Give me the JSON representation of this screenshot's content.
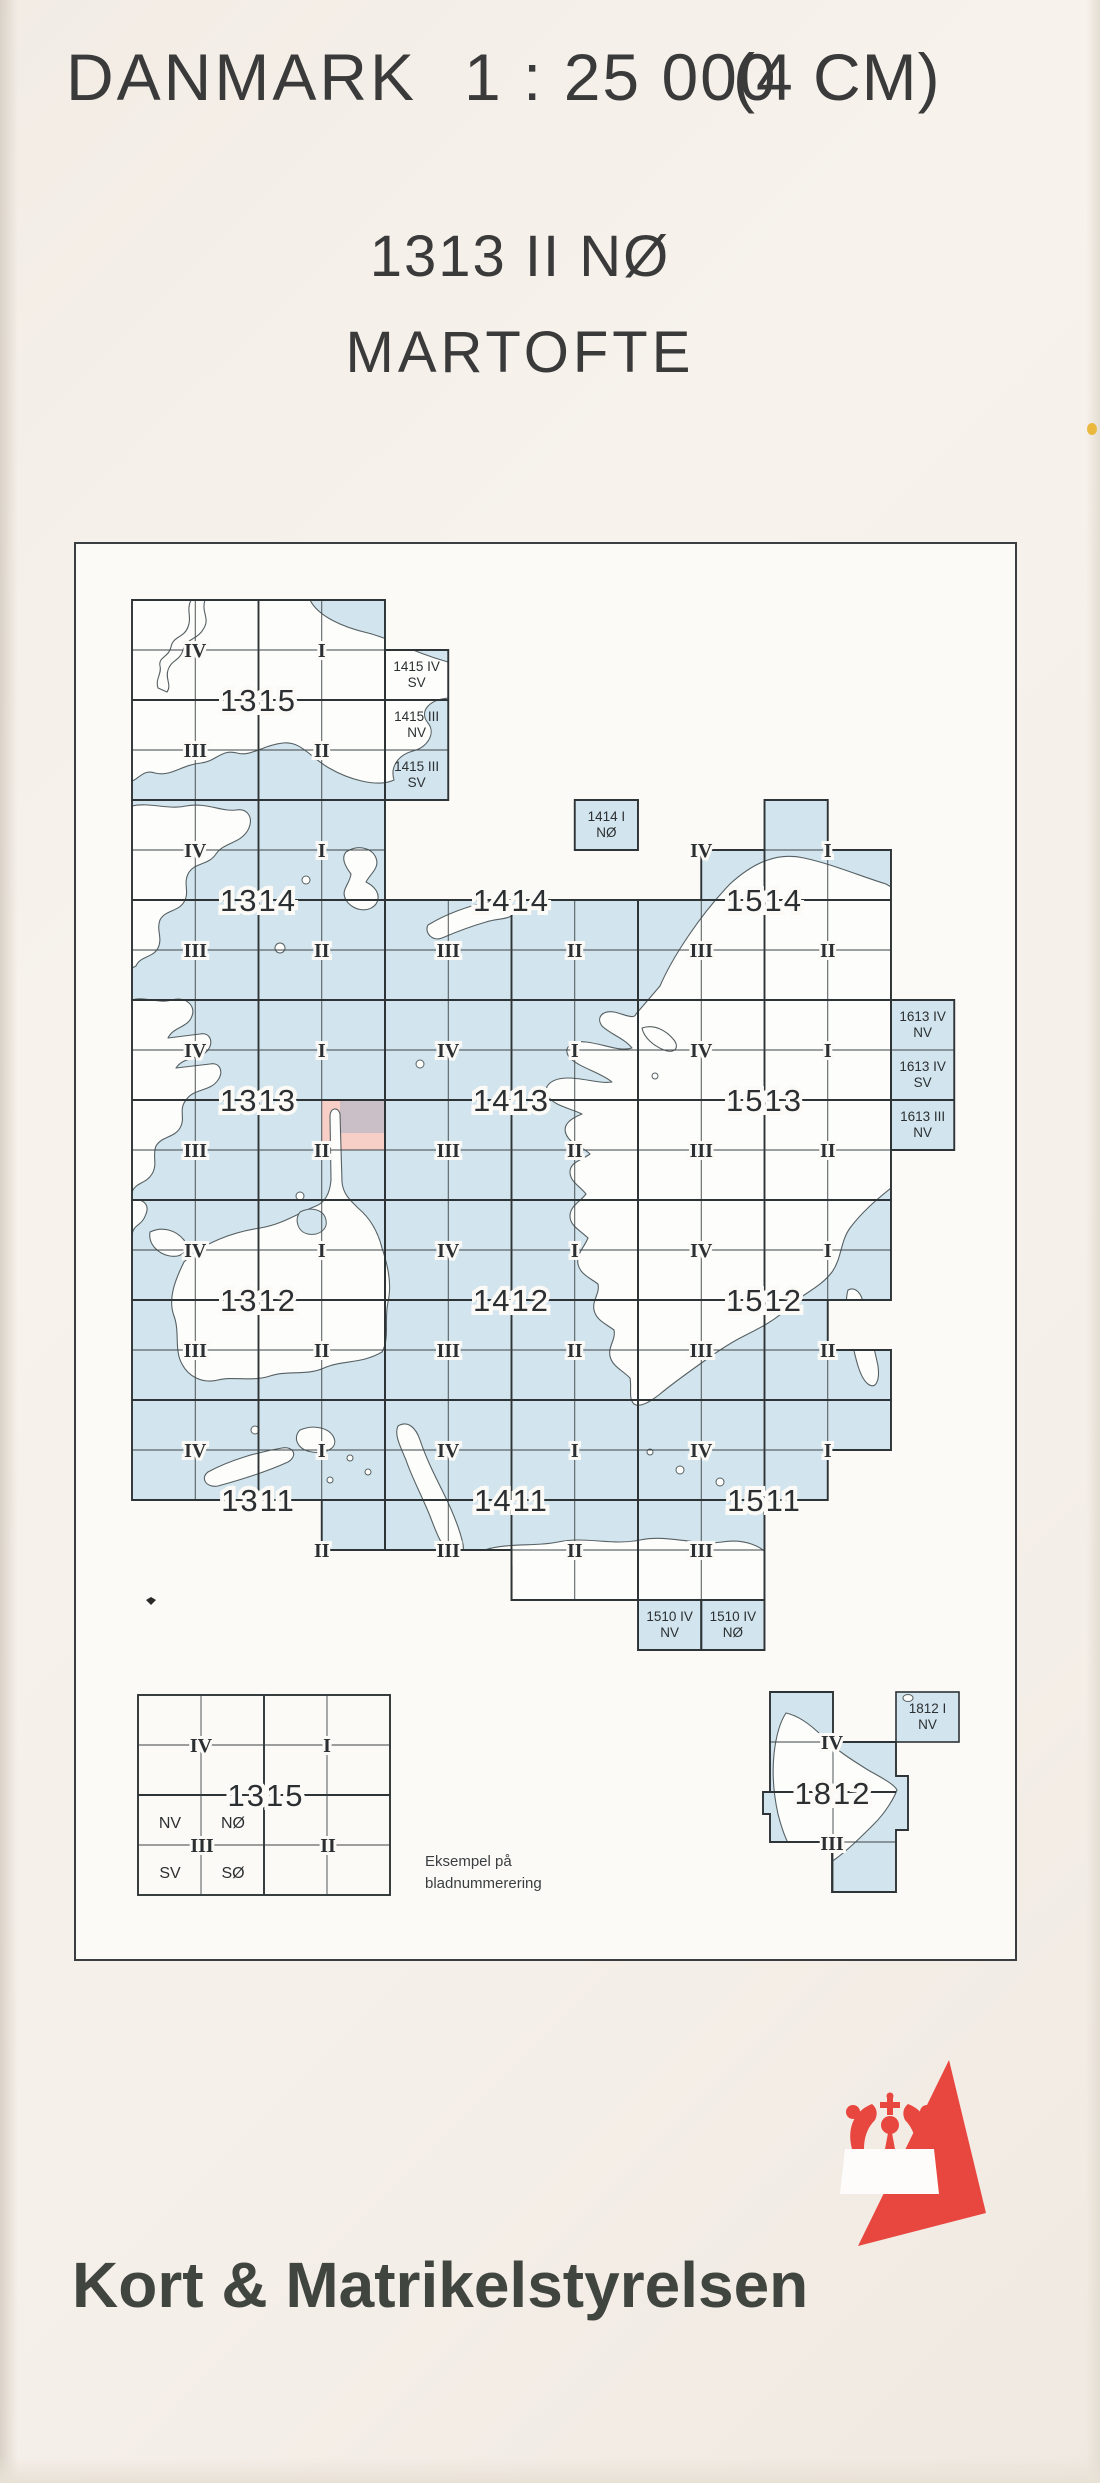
{
  "page": {
    "country": "DANMARK",
    "scale": "1 : 25 000",
    "cm_note": "(4 CM)",
    "sheet_number": "1313 II NØ",
    "sheet_name": "MARTOFTE",
    "publisher": "Kort & Matrikelstyrelsen"
  },
  "colors": {
    "sea": "#d2e4ed",
    "paper_in": "#fbfaf7",
    "line": "#2e3335",
    "thin_line": "#3d4345",
    "coast": "#566063",
    "land": "#fdfdfb",
    "pink": "#f7cfc7",
    "gray_tint": "#c2bcc6",
    "label": "#2b2f31",
    "red": "#e8473f",
    "frame": "#3a3e40",
    "mark": "#2c2a28",
    "spot_yellow": "#e9b83d"
  },
  "index_map": {
    "frame_px": [
      75,
      543,
      1016,
      1960
    ],
    "grid": {
      "x0": 132,
      "y0": 600,
      "cell_w": 63.25,
      "cell_h": 50
    },
    "sea_cells": [
      [
        0,
        0,
        4,
        4
      ],
      [
        4,
        1,
        5,
        4
      ],
      [
        0,
        4,
        4,
        8
      ],
      [
        4,
        6,
        8,
        8
      ],
      [
        7,
        4,
        8,
        5
      ],
      [
        8,
        6,
        12,
        8
      ],
      [
        9,
        5,
        12,
        6
      ],
      [
        10,
        4,
        11,
        5
      ],
      [
        0,
        8,
        4,
        12
      ],
      [
        4,
        8,
        8,
        12
      ],
      [
        8,
        8,
        12,
        12
      ],
      [
        12,
        8,
        13,
        11
      ],
      [
        0,
        12,
        4,
        16
      ],
      [
        4,
        12,
        8,
        16
      ],
      [
        8,
        12,
        11,
        16
      ],
      [
        11,
        12,
        12,
        14
      ],
      [
        11,
        15,
        12,
        16
      ],
      [
        0,
        16,
        4,
        18
      ],
      [
        3,
        18,
        4,
        19
      ],
      [
        4,
        16,
        8,
        19
      ],
      [
        6,
        19,
        8,
        20
      ],
      [
        8,
        16,
        12,
        17
      ],
      [
        8,
        17,
        11,
        18
      ],
      [
        8,
        18,
        10,
        20
      ],
      [
        8,
        20,
        9,
        21
      ],
      [
        9,
        20,
        10,
        21
      ]
    ],
    "outlines": [
      [
        [
          0,
          0
        ],
        [
          4,
          0
        ],
        [
          4,
          4
        ],
        [
          0,
          4
        ]
      ],
      [
        [
          4,
          1
        ],
        [
          5,
          1
        ],
        [
          5,
          4
        ],
        [
          4,
          4
        ]
      ],
      [
        [
          0,
          4
        ],
        [
          4,
          4
        ],
        [
          4,
          8
        ],
        [
          0,
          8
        ]
      ],
      [
        [
          4,
          6
        ],
        [
          8,
          6
        ],
        [
          8,
          8
        ],
        [
          4,
          8
        ]
      ],
      [
        [
          7,
          4
        ],
        [
          8,
          4
        ],
        [
          8,
          5
        ],
        [
          7,
          5
        ]
      ],
      [
        [
          8,
          6
        ],
        [
          9,
          6
        ],
        [
          9,
          5
        ],
        [
          10,
          5
        ],
        [
          10,
          4
        ],
        [
          11,
          4
        ],
        [
          11,
          5
        ],
        [
          12,
          5
        ],
        [
          12,
          8
        ],
        [
          8,
          8
        ]
      ],
      [
        [
          0,
          8
        ],
        [
          4,
          8
        ],
        [
          4,
          12
        ],
        [
          0,
          12
        ]
      ],
      [
        [
          4,
          8
        ],
        [
          8,
          8
        ],
        [
          8,
          12
        ],
        [
          4,
          12
        ]
      ],
      [
        [
          8,
          8
        ],
        [
          12,
          8
        ],
        [
          12,
          12
        ],
        [
          8,
          12
        ]
      ],
      [
        [
          12,
          8
        ],
        [
          13,
          8
        ],
        [
          13,
          11
        ],
        [
          12,
          11
        ]
      ],
      [
        [
          0,
          12
        ],
        [
          4,
          12
        ],
        [
          4,
          16
        ],
        [
          0,
          16
        ]
      ],
      [
        [
          4,
          12
        ],
        [
          8,
          12
        ],
        [
          8,
          16
        ],
        [
          4,
          16
        ]
      ],
      [
        [
          8,
          12
        ],
        [
          12,
          12
        ],
        [
          12,
          14
        ],
        [
          11,
          14
        ],
        [
          11,
          15
        ],
        [
          12,
          15
        ],
        [
          12,
          16
        ],
        [
          8,
          16
        ]
      ],
      [
        [
          0,
          16
        ],
        [
          4,
          16
        ],
        [
          4,
          19
        ],
        [
          3,
          19
        ],
        [
          3,
          18
        ],
        [
          0,
          18
        ]
      ],
      [
        [
          4,
          16
        ],
        [
          8,
          16
        ],
        [
          8,
          20
        ],
        [
          6,
          20
        ],
        [
          6,
          19
        ],
        [
          4,
          19
        ]
      ],
      [
        [
          8,
          16
        ],
        [
          12,
          16
        ],
        [
          12,
          17
        ],
        [
          11,
          17
        ],
        [
          11,
          18
        ],
        [
          10,
          18
        ],
        [
          10,
          20
        ],
        [
          8,
          20
        ]
      ],
      [
        [
          8,
          20
        ],
        [
          9,
          20
        ],
        [
          9,
          21
        ],
        [
          8,
          21
        ]
      ],
      [
        [
          9,
          20
        ],
        [
          10,
          20
        ],
        [
          10,
          21
        ],
        [
          9,
          21
        ]
      ]
    ],
    "block_labels": [
      {
        "t": "1315",
        "ci": 2,
        "rj": 2
      },
      {
        "t": "1314",
        "ci": 2,
        "rj": 6
      },
      {
        "t": "1414",
        "ci": 6,
        "rj": 6
      },
      {
        "t": "1514",
        "ci": 10,
        "rj": 6
      },
      {
        "t": "1313",
        "ci": 2,
        "rj": 10
      },
      {
        "t": "1413",
        "ci": 6,
        "rj": 10
      },
      {
        "t": "1513",
        "ci": 10,
        "rj": 10
      },
      {
        "t": "1312",
        "ci": 2,
        "rj": 14
      },
      {
        "t": "1412",
        "ci": 6,
        "rj": 14
      },
      {
        "t": "1512",
        "ci": 10,
        "rj": 14
      },
      {
        "t": "1311",
        "ci": 2,
        "rj": 18
      },
      {
        "t": "1411",
        "ci": 6,
        "rj": 18
      },
      {
        "t": "1511",
        "ci": 10,
        "rj": 18
      }
    ],
    "quadrant_labels": [
      {
        "t": "IV",
        "ci": 1,
        "rj": 1
      },
      {
        "t": "I",
        "ci": 3,
        "rj": 1
      },
      {
        "t": "III",
        "ci": 1,
        "rj": 3
      },
      {
        "t": "II",
        "ci": 3,
        "rj": 3
      },
      {
        "t": "IV",
        "ci": 1,
        "rj": 5
      },
      {
        "t": "I",
        "ci": 3,
        "rj": 5
      },
      {
        "t": "III",
        "ci": 1,
        "rj": 7
      },
      {
        "t": "II",
        "ci": 3,
        "rj": 7
      },
      {
        "t": "III",
        "ci": 5,
        "rj": 7
      },
      {
        "t": "II",
        "ci": 7,
        "rj": 7
      },
      {
        "t": "IV",
        "ci": 9,
        "rj": 5
      },
      {
        "t": "I",
        "ci": 11,
        "rj": 5
      },
      {
        "t": "III",
        "ci": 9,
        "rj": 7
      },
      {
        "t": "II",
        "ci": 11,
        "rj": 7
      },
      {
        "t": "IV",
        "ci": 1,
        "rj": 9
      },
      {
        "t": "I",
        "ci": 3,
        "rj": 9
      },
      {
        "t": "III",
        "ci": 1,
        "rj": 11
      },
      {
        "t": "II",
        "ci": 3,
        "rj": 11
      },
      {
        "t": "IV",
        "ci": 5,
        "rj": 9
      },
      {
        "t": "I",
        "ci": 7,
        "rj": 9
      },
      {
        "t": "III",
        "ci": 5,
        "rj": 11
      },
      {
        "t": "II",
        "ci": 7,
        "rj": 11
      },
      {
        "t": "IV",
        "ci": 9,
        "rj": 9
      },
      {
        "t": "I",
        "ci": 11,
        "rj": 9
      },
      {
        "t": "III",
        "ci": 9,
        "rj": 11
      },
      {
        "t": "II",
        "ci": 11,
        "rj": 11
      },
      {
        "t": "IV",
        "ci": 1,
        "rj": 13
      },
      {
        "t": "I",
        "ci": 3,
        "rj": 13
      },
      {
        "t": "III",
        "ci": 1,
        "rj": 15
      },
      {
        "t": "II",
        "ci": 3,
        "rj": 15
      },
      {
        "t": "IV",
        "ci": 5,
        "rj": 13
      },
      {
        "t": "I",
        "ci": 7,
        "rj": 13
      },
      {
        "t": "III",
        "ci": 5,
        "rj": 15
      },
      {
        "t": "II",
        "ci": 7,
        "rj": 15
      },
      {
        "t": "IV",
        "ci": 9,
        "rj": 13
      },
      {
        "t": "I",
        "ci": 11,
        "rj": 13
      },
      {
        "t": "III",
        "ci": 9,
        "rj": 15
      },
      {
        "t": "II",
        "ci": 11,
        "rj": 15
      },
      {
        "t": "IV",
        "ci": 1,
        "rj": 17
      },
      {
        "t": "I",
        "ci": 3,
        "rj": 17
      },
      {
        "t": "II",
        "ci": 3,
        "rj": 19
      },
      {
        "t": "IV",
        "ci": 5,
        "rj": 17
      },
      {
        "t": "I",
        "ci": 7,
        "rj": 17
      },
      {
        "t": "III",
        "ci": 5,
        "rj": 19
      },
      {
        "t": "II",
        "ci": 7,
        "rj": 19
      },
      {
        "t": "IV",
        "ci": 9,
        "rj": 17
      },
      {
        "t": "I",
        "ci": 11,
        "rj": 17
      },
      {
        "t": "III",
        "ci": 9,
        "rj": 19
      }
    ],
    "cell_labels": [
      {
        "l1": "1415 IV",
        "l2": "SV",
        "ci": 4,
        "rj": 1
      },
      {
        "l1": "1415 III",
        "l2": "NV",
        "ci": 4,
        "rj": 2
      },
      {
        "l1": "1415 III",
        "l2": "SV",
        "ci": 4,
        "rj": 3
      },
      {
        "l1": "1414 I",
        "l2": "NØ",
        "ci": 7,
        "rj": 4
      },
      {
        "l1": "1613 IV",
        "l2": "NV",
        "ci": 12,
        "rj": 8
      },
      {
        "l1": "1613 IV",
        "l2": "SV",
        "ci": 12,
        "rj": 9
      },
      {
        "l1": "1613 III",
        "l2": "NV",
        "ci": 12,
        "rj": 10
      },
      {
        "l1": "1510 IV",
        "l2": "NV",
        "ci": 8,
        "rj": 20
      },
      {
        "l1": "1510 IV",
        "l2": "NØ",
        "ci": 9,
        "rj": 20
      }
    ],
    "highlight": {
      "cell_ci": 3,
      "cell_rj": 10,
      "gray_rect": [
        340,
        1100,
        385,
        1133
      ]
    },
    "land_paths": [
      "M132 600 L205 600 C201 612 210 618 204 628 C198 640 186 638 183 650 C180 661 171 660 168 670 C165 679 172 685 167 692 L158 688 C155 679 162 674 160 666 C158 657 169 657 171 647 C173 636 184 638 188 627 C192 617 186 610 191 600 L310 600 C318 616 342 627 368 633 C392 639 412 652 448 662 L448 698 C428 700 419 712 428 723 C436 733 428 747 413 751 C398 755 390 767 394 780 C377 788 348 779 329 768 C310 757 301 741 283 743 C263 745 251 757 237 753 C221 749 217 761 201 763 C181 765 171 777 155 773 C143 769 139 779 132 781 Z",
      "M132 806 C150 802 168 810 186 806 C206 802 222 812 236 810 C248 808 254 818 248 830 C240 844 224 842 216 854 C208 866 194 862 188 874 C183 884 190 892 184 902 C178 912 165 910 160 920 C156 930 163 938 158 948 C153 958 140 956 136 966 L132 968 Z",
      "M132 1000 C146 996 158 1004 172 1000 C186 996 196 1006 192 1016 C188 1028 174 1026 168 1038 L200 1034 C210 1032 214 1042 208 1050 C200 1060 184 1056 176 1068 L210 1064 C220 1062 224 1072 218 1080 C210 1092 194 1088 186 1100 C178 1110 186 1118 180 1128 C174 1138 162 1136 156 1146 C152 1156 158 1164 152 1174 C146 1184 136 1182 132 1192 Z",
      "M132 1200 C142 1198 150 1204 146 1214 C142 1226 134 1224 132 1234 Z",
      "M150 1232 C162 1226 176 1230 184 1240 C190 1250 182 1258 170 1256 C158 1254 148 1244 150 1232 Z",
      "M346 852 C358 844 372 848 376 858 C380 868 370 874 366 882 C374 886 382 894 376 904 C368 914 352 910 346 900 C340 890 350 884 351 874 C345 866 341 858 346 852 Z",
      "M428 925 C446 914 468 906 488 902 C504 898 516 902 514 912 C512 920 498 918 486 922 C472 926 456 932 442 938 C432 942 424 932 428 925 Z",
      "M660 986 C672 958 700 915 730 884 C754 862 778 852 804 858 C832 864 860 876 886 884 L891 887 L891 1188 C876 1200 862 1212 850 1228 C840 1242 842 1258 832 1272 C820 1288 802 1294 790 1306 C776 1320 760 1328 744 1336 C728 1344 714 1354 700 1364 C686 1374 672 1384 660 1394 C650 1402 640 1408 634 1404 C628 1398 632 1388 630 1378 C622 1370 612 1366 610 1356 C608 1346 616 1340 614 1330 C606 1324 596 1320 594 1310 C592 1300 600 1294 598 1284 C590 1278 580 1274 578 1264 C576 1254 584 1248 588 1238 C580 1230 570 1226 570 1216 C570 1206 580 1202 586 1194 C580 1186 570 1182 570 1172 C570 1162 582 1160 590 1154 C582 1146 570 1144 566 1134 C562 1124 572 1118 582 1114 C570 1108 554 1106 548 1096 C542 1086 552 1078 568 1078 C584 1078 600 1084 612 1082 C600 1072 580 1068 570 1058 C562 1049 570 1040 586 1042 C604 1044 620 1052 632 1048 C624 1038 610 1034 602 1026 C596 1018 602 1010 614 1012 C624 1014 634 1020 636 1014 Z",
      "M184 1262 C204 1242 234 1232 260 1228 C284 1224 300 1212 316 1206 C326 1202 330 1192 331 1180 L330 1116 C330 1108 338 1106 340 1114 L342 1182 C343 1194 350 1200 358 1208 C370 1218 378 1232 382 1248 C388 1266 392 1284 388 1302 C384 1320 390 1338 382 1352 C362 1364 342 1360 324 1368 C306 1376 288 1370 270 1376 C252 1382 234 1376 218 1380 C202 1384 188 1376 182 1364 C174 1350 180 1332 174 1316 C168 1300 174 1282 184 1262 Z",
      "M208 1472 C230 1460 258 1452 282 1448 C294 1446 298 1456 288 1462 C266 1472 240 1480 218 1486 C206 1488 200 1478 208 1472 Z",
      "M300 1430 C314 1424 330 1428 334 1438 C338 1448 326 1454 312 1452 C298 1450 292 1438 300 1430 Z",
      "M398 1426 C408 1420 416 1428 420 1440 C426 1458 434 1474 442 1490 C450 1506 458 1524 462 1540 C466 1554 460 1562 452 1556 C442 1548 436 1532 430 1516 C422 1496 412 1478 406 1460 C400 1446 394 1434 398 1426 Z",
      "M470 1556 C500 1540 530 1548 558 1542 C586 1536 612 1546 640 1540 C668 1534 696 1546 722 1542 C746 1538 762 1548 765 1552 L765 1600 L512 1600 L512 1566 C498 1570 482 1566 470 1556 Z",
      "M642 1028 C654 1024 666 1030 674 1040 C680 1048 674 1054 664 1050 C654 1046 644 1038 642 1028 Z",
      "M848 1290 C856 1286 862 1294 864 1306 C868 1326 874 1346 878 1366 C880 1380 876 1390 868 1384 C860 1378 856 1360 852 1342 C848 1324 844 1304 848 1290 Z"
    ],
    "sea_overlays": [
      "M300 1212 C312 1206 324 1210 326 1220 C328 1230 318 1236 308 1234 C298 1232 294 1220 300 1212 Z"
    ],
    "islands": [
      [
        306,
        880,
        4
      ],
      [
        280,
        948,
        5
      ],
      [
        420,
        1064,
        4
      ],
      [
        655,
        1076,
        3
      ],
      [
        300,
        1196,
        4
      ],
      [
        350,
        1458,
        3
      ],
      [
        368,
        1472,
        3
      ],
      [
        330,
        1480,
        3
      ],
      [
        255,
        1430,
        4
      ],
      [
        680,
        1470,
        4
      ],
      [
        650,
        1452,
        3
      ],
      [
        720,
        1482,
        4
      ]
    ]
  },
  "example_block": {
    "rect": [
      138,
      1695,
      390,
      1895
    ],
    "number": "1315",
    "quadrants": [
      {
        "t": "IV",
        "x": 201,
        "y": 1745
      },
      {
        "t": "I",
        "x": 327,
        "y": 1745
      },
      {
        "t": "III",
        "x": 202,
        "y": 1845
      },
      {
        "t": "II",
        "x": 328,
        "y": 1845
      }
    ],
    "subcells": [
      {
        "t": "NV",
        "x": 170,
        "y": 1822
      },
      {
        "t": "NØ",
        "x": 233,
        "y": 1822
      },
      {
        "t": "SV",
        "x": 170,
        "y": 1872
      },
      {
        "t": "SØ",
        "x": 233,
        "y": 1872
      }
    ],
    "caption_line1": "Eksempel på",
    "caption_line2": "bladnummerering"
  },
  "inset_1812": {
    "sea_rects": [
      [
        770,
        1692,
        833,
        1742
      ],
      [
        770,
        1742,
        896,
        1842
      ],
      [
        832,
        1842,
        896,
        1892
      ],
      [
        763,
        1792,
        770,
        1814
      ],
      [
        896,
        1776,
        908,
        1830
      ]
    ],
    "outline": "M770 1692 L833 1692 L833 1742 L896 1742 L896 1776 L908 1776 L908 1830 L896 1830 L896 1892 L832 1892 L832 1842 L770 1842 L770 1814 L763 1814 L763 1792 L770 1792 Z",
    "detached_cell": [
      896,
      1692,
      959,
      1742
    ],
    "detached_label1": "1812 I",
    "detached_label2": "NV",
    "labels": [
      {
        "t": "IV",
        "x": 832,
        "y": 1742,
        "kind": "quad"
      },
      {
        "t": "1812",
        "x": 833,
        "y": 1793,
        "kind": "block"
      },
      {
        "t": "III",
        "x": 832,
        "y": 1843,
        "kind": "quad"
      }
    ],
    "land": "M786 1713 C800 1716 812 1726 822 1736 C836 1750 852 1760 868 1770 C882 1778 894 1784 897 1790 C894 1798 886 1812 874 1824 C862 1836 848 1850 834 1860 C822 1868 806 1866 796 1856 C788 1846 782 1830 778 1814 C774 1796 772 1774 774 1754 C776 1736 780 1722 786 1713 Z",
    "small_island": [
      908,
      1698,
      5,
      3.5
    ]
  }
}
